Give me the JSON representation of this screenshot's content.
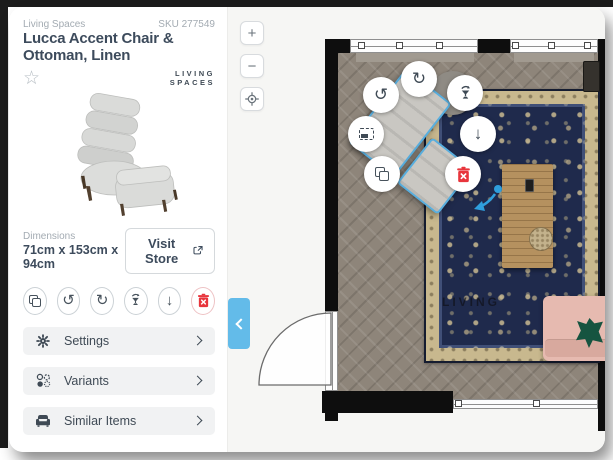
{
  "sidebar": {
    "brand": "Living Spaces",
    "sku": "SKU 277549",
    "title": "Lucca Accent Chair & Ottoman, Linen",
    "logo_line1": "LIVING",
    "logo_line2": "SPACES",
    "favorite_glyph": "☆",
    "dimensions_label": "Dimensions",
    "dimensions_value": "71cm x 153cm x 94cm",
    "visit_store_label": "Visit Store",
    "actions": [
      {
        "name": "duplicate"
      },
      {
        "name": "rotate-ccw",
        "glyph": "↺"
      },
      {
        "name": "rotate-cw",
        "glyph": "↻"
      },
      {
        "name": "replace"
      },
      {
        "name": "move-down",
        "glyph": "↓"
      },
      {
        "name": "delete"
      }
    ],
    "accordions": [
      {
        "label": "Settings"
      },
      {
        "label": "Variants"
      },
      {
        "label": "Similar Items"
      }
    ]
  },
  "canvas": {
    "zoom_in": "+",
    "zoom_out": "−",
    "watermark": "LIVING"
  },
  "colors": {
    "accent_blue": "#63bbe9",
    "selection_blue": "#58aede",
    "delete_red": "#e8353c",
    "title_text": "#3d4b5c",
    "muted_text": "#a3abb2",
    "wall_black": "#0e0e0e",
    "rug_navy": "#1f2a4c",
    "rug_beige": "#c8b88e",
    "sofa_pink": "#e6bab0",
    "pillow_green": "#165440"
  }
}
